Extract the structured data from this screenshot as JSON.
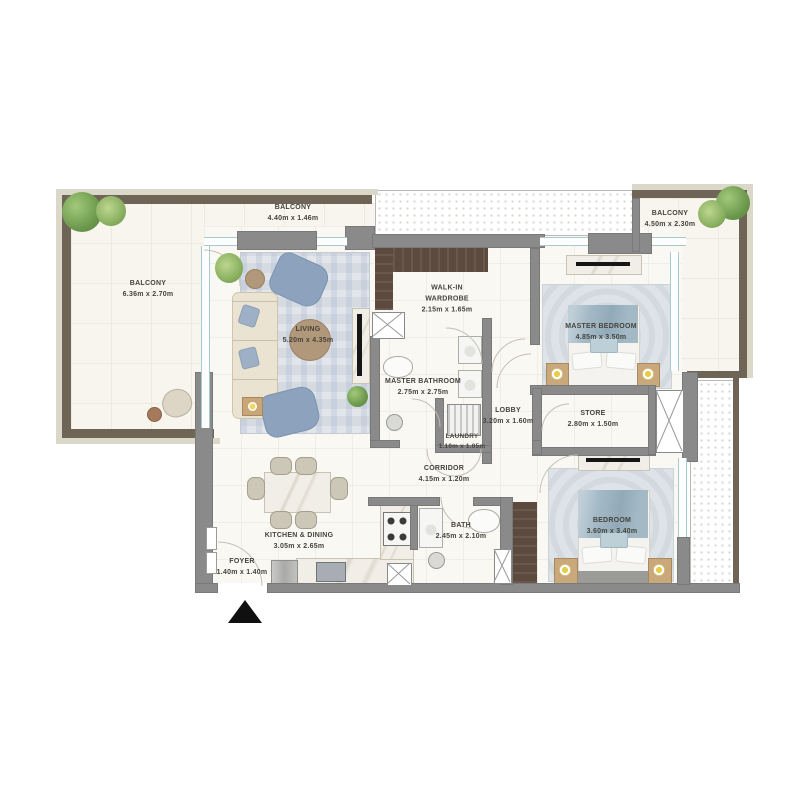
{
  "rooms": [
    {
      "id": "balcony-left",
      "name": "BALCONY",
      "dims": "6.36m x 2.70m"
    },
    {
      "id": "balcony-top",
      "name": "BALCONY",
      "dims": "4.40m x 1.46m"
    },
    {
      "id": "balcony-right",
      "name": "BALCONY",
      "dims": "4.50m x 2.30m"
    },
    {
      "id": "living",
      "name": "LIVING",
      "dims": "5.20m x 4.35m"
    },
    {
      "id": "walk-in-wardrobe",
      "name": "WALK-IN WARDROBE",
      "dims": "2.15m x 1.65m"
    },
    {
      "id": "master-bathroom",
      "name": "MASTER BATHROOM",
      "dims": "2.75m x 2.75m"
    },
    {
      "id": "master-bedroom",
      "name": "MASTER BEDROOM",
      "dims": "4.85m x 3.50m"
    },
    {
      "id": "lobby",
      "name": "LOBBY",
      "dims": "3.20m x 1.60m"
    },
    {
      "id": "store",
      "name": "STORE",
      "dims": "2.80m x 1.50m"
    },
    {
      "id": "laundry",
      "name": "LAUNDRY",
      "dims": "1.10m x 1.05m"
    },
    {
      "id": "corridor",
      "name": "CORRIDOR",
      "dims": "4.15m x 1.20m"
    },
    {
      "id": "bath",
      "name": "BATH",
      "dims": "2.45m x 2.10m"
    },
    {
      "id": "bedroom",
      "name": "BEDROOM",
      "dims": "3.60m x 3.40m"
    },
    {
      "id": "kitchen-dining",
      "name": "KITCHEN & DINING",
      "dims": "3.05m x 2.65m"
    },
    {
      "id": "foyer",
      "name": "FOYER",
      "dims": "1.40m x 1.40m"
    }
  ],
  "icons": {
    "entrance_marker": "black-triangle-up",
    "service_shaft": "crossed-box",
    "plants": "greenery-circles"
  },
  "colors": {
    "interior_wall": "#8a8a8a",
    "exterior_wall": "#6e6557",
    "exterior_band": "#dcd8c9",
    "floor": "#faf8f3",
    "glazing": "#a6c9d2",
    "wardrobe_wood": "#5d4a3f",
    "fabric_accent": "#8da3bd",
    "rug": "#d6dbe2"
  }
}
